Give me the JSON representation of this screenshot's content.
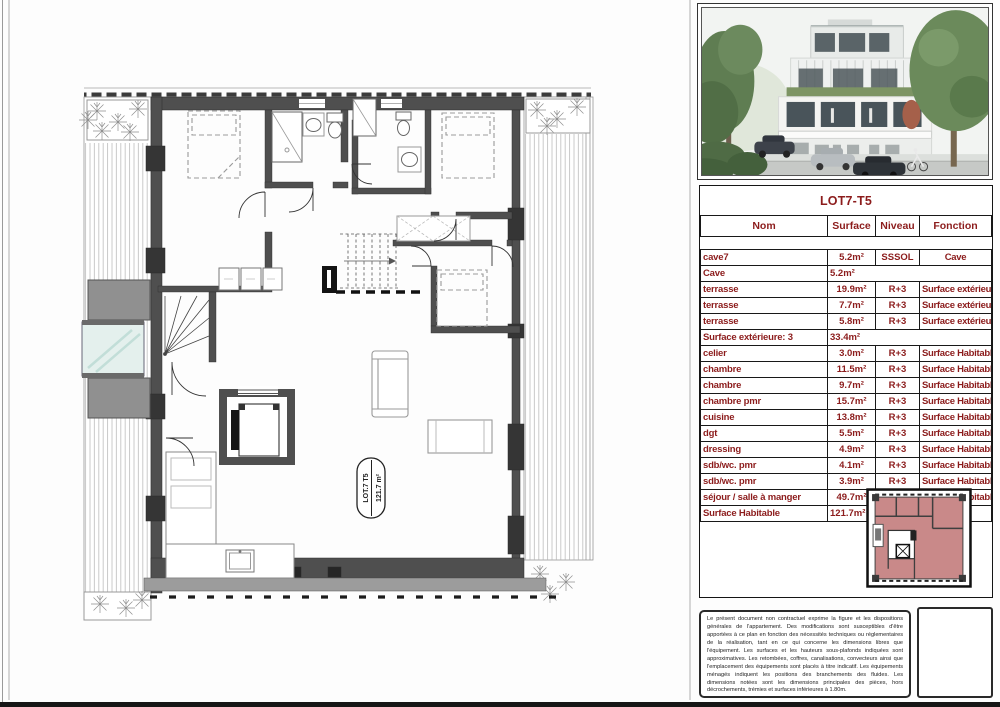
{
  "table": {
    "title": "LOT7-T5",
    "columns": [
      "Nom",
      "Surface",
      "Niveau",
      "Fonction"
    ],
    "rows": [
      {
        "name": "cave7",
        "surface": "5.2m²",
        "niveau": "SSSOL",
        "fonction": "Cave"
      },
      {
        "name": "Cave",
        "surface": "5.2m²"
      },
      {
        "name": "terrasse",
        "surface": "19.9m²",
        "niveau": "R+3",
        "fonction": "Surface extérieure"
      },
      {
        "name": "terrasse",
        "surface": "7.7m²",
        "niveau": "R+3",
        "fonction": "Surface extérieure"
      },
      {
        "name": "terrasse",
        "surface": "5.8m²",
        "niveau": "R+3",
        "fonction": "Surface extérieure"
      },
      {
        "name": "Surface extérieure: 3",
        "surface": "33.4m²"
      },
      {
        "name": "celier",
        "surface": "3.0m²",
        "niveau": "R+3",
        "fonction": "Surface Habitable"
      },
      {
        "name": "chambre",
        "surface": "11.5m²",
        "niveau": "R+3",
        "fonction": "Surface Habitable"
      },
      {
        "name": "chambre",
        "surface": "9.7m²",
        "niveau": "R+3",
        "fonction": "Surface Habitable"
      },
      {
        "name": "chambre pmr",
        "surface": "15.7m²",
        "niveau": "R+3",
        "fonction": "Surface Habitable"
      },
      {
        "name": "cuisine",
        "surface": "13.8m²",
        "niveau": "R+3",
        "fonction": "Surface Habitable"
      },
      {
        "name": "dgt",
        "surface": "5.5m²",
        "niveau": "R+3",
        "fonction": "Surface Habitable"
      },
      {
        "name": "dressing",
        "surface": "4.9m²",
        "niveau": "R+3",
        "fonction": "Surface Habitable"
      },
      {
        "name": "sdb/wc. pmr",
        "surface": "4.1m²",
        "niveau": "R+3",
        "fonction": "Surface Habitable"
      },
      {
        "name": "sdb/wc. pmr",
        "surface": "3.9m²",
        "niveau": "R+3",
        "fonction": "Surface Habitable"
      },
      {
        "name": "séjour / salle à manger",
        "surface": "49.7m²",
        "niveau": "R+3",
        "fonction": "Surface Habitable"
      },
      {
        "name": "Surface Habitable",
        "surface": "121.7m²"
      }
    ]
  },
  "plan_label": {
    "line1": "LOT.7 T5",
    "line2": "121.7 m²"
  },
  "legal": {
    "text": "Le présent document non contractuel exprime la figure et les dispositions générales de l'appartement. Des modifications sont susceptibles d'être apportées à ce plan en fonction des nécessités techniques ou réglementaires de la réalisation, tant en ce qui concerne les dimensions libres que l'équipement. Les surfaces et les hauteurs sous-plafonds indiquées sont approximatives. Les retombées, coffres, canalisations, convecteurs ainsi que l'emplacement des équipements sont placés à titre indicatif. Les équipements ménagés indiquent les positions des branchements des fluides. Les dimensions notées sont les dimensions principales des pièces, hors décrochements, trémies et surfaces inférieures à 1.80m."
  },
  "colors": {
    "accent_maroon": "#8c1c1c",
    "wall_gray": "#4f4f4f",
    "mini_plan_pink": "#c98989",
    "glazing_teal": "#e4f0ed",
    "hedge_green": "#7d9464"
  }
}
